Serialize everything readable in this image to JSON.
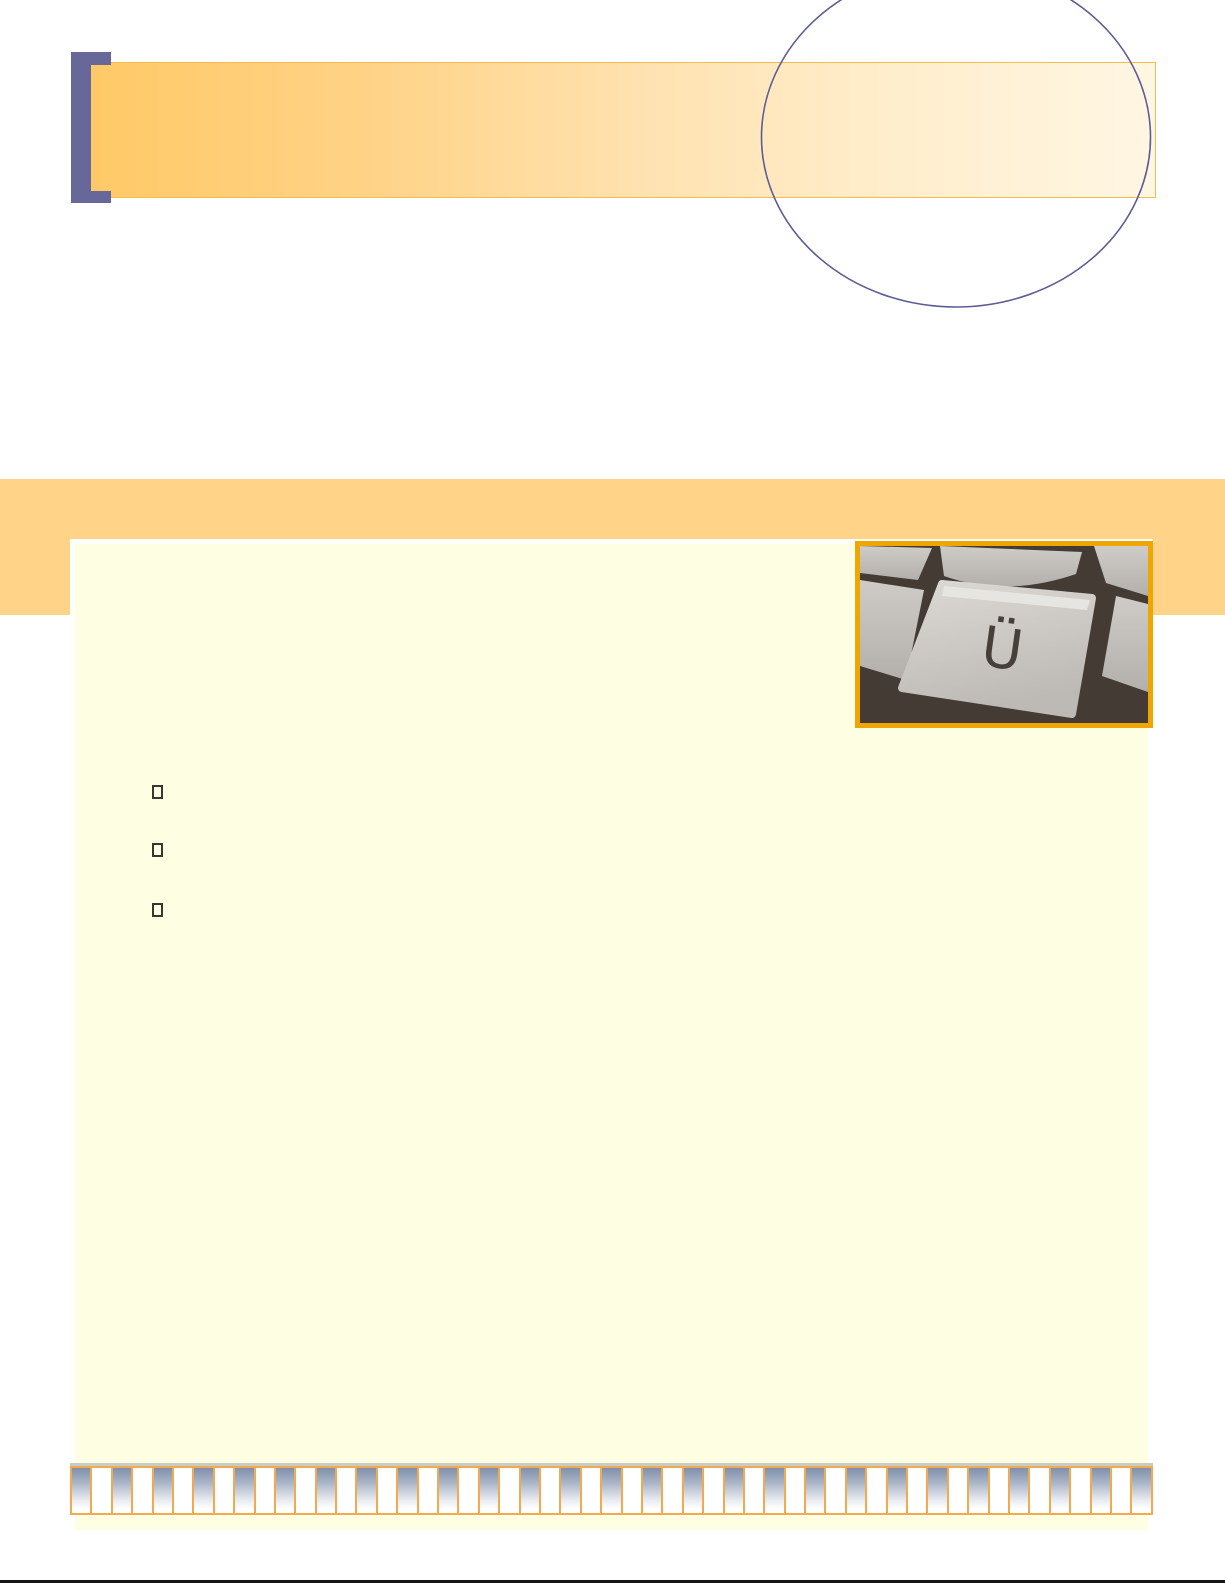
{
  "page": {
    "kind": "presentation-template-page",
    "background_color": "#FFFFFF"
  },
  "header_banner": {
    "bracket_color": "#67679A",
    "gradient_start_color": "#FFC966",
    "gradient_end_color": "#FFF6E3",
    "border_color": "#FBBA4C",
    "ellipse_outline_color": "#5C5C96"
  },
  "accent_band": {
    "color": "#FFD488"
  },
  "content_panel": {
    "fill_color": "#FEFFE2",
    "outline_color": "#FFFFFF"
  },
  "bullet_list": {
    "count": 3,
    "glyph": "empty-box-placeholder",
    "outline_color": "#3B372F"
  },
  "photo": {
    "name": "keyboard-key-closeup",
    "key_letter": "Ü",
    "frame_color": "#F0A600"
  },
  "piano_strip": {
    "cell_count": 53,
    "border_color": "#F3A94E",
    "gradient_top_color": "#8090AB",
    "shadow_line_color": "#C7CCC6"
  },
  "footer_rule": {
    "color": "#161616"
  }
}
